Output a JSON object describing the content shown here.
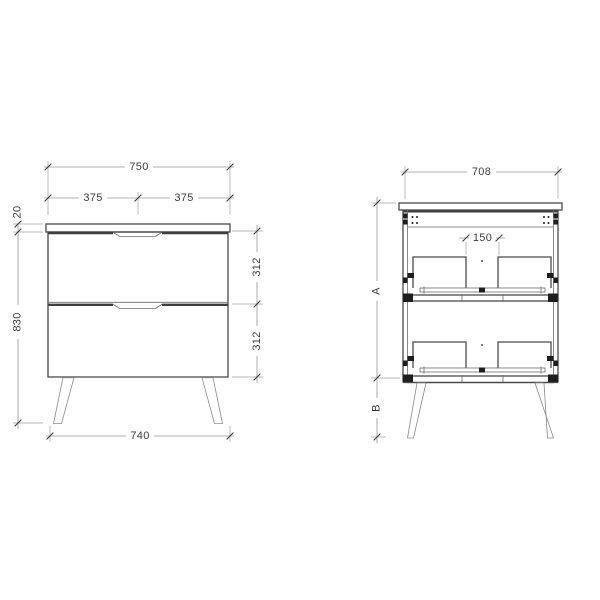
{
  "drawing": {
    "views": {
      "front_view_name": "front-elevation",
      "section_view_name": "internal-section"
    },
    "front_view": {
      "dims": {
        "overall_width": "750",
        "left_half_width": "375",
        "right_half_width": "375",
        "top_thickness": "20",
        "overall_height": "830",
        "top_drawer_height": "312",
        "bottom_drawer_height": "312",
        "base_width": "740"
      }
    },
    "section_view": {
      "dims": {
        "overall_width": "708",
        "center_gap": "150",
        "carcass_height": "A",
        "leg_height": "B"
      }
    },
    "colors": {
      "line": "#4a4a4a",
      "dimension_line": "#9a9a9a",
      "text": "#3d3d3d",
      "hardware": "#1e1e1e",
      "background": "#ffffff"
    }
  }
}
